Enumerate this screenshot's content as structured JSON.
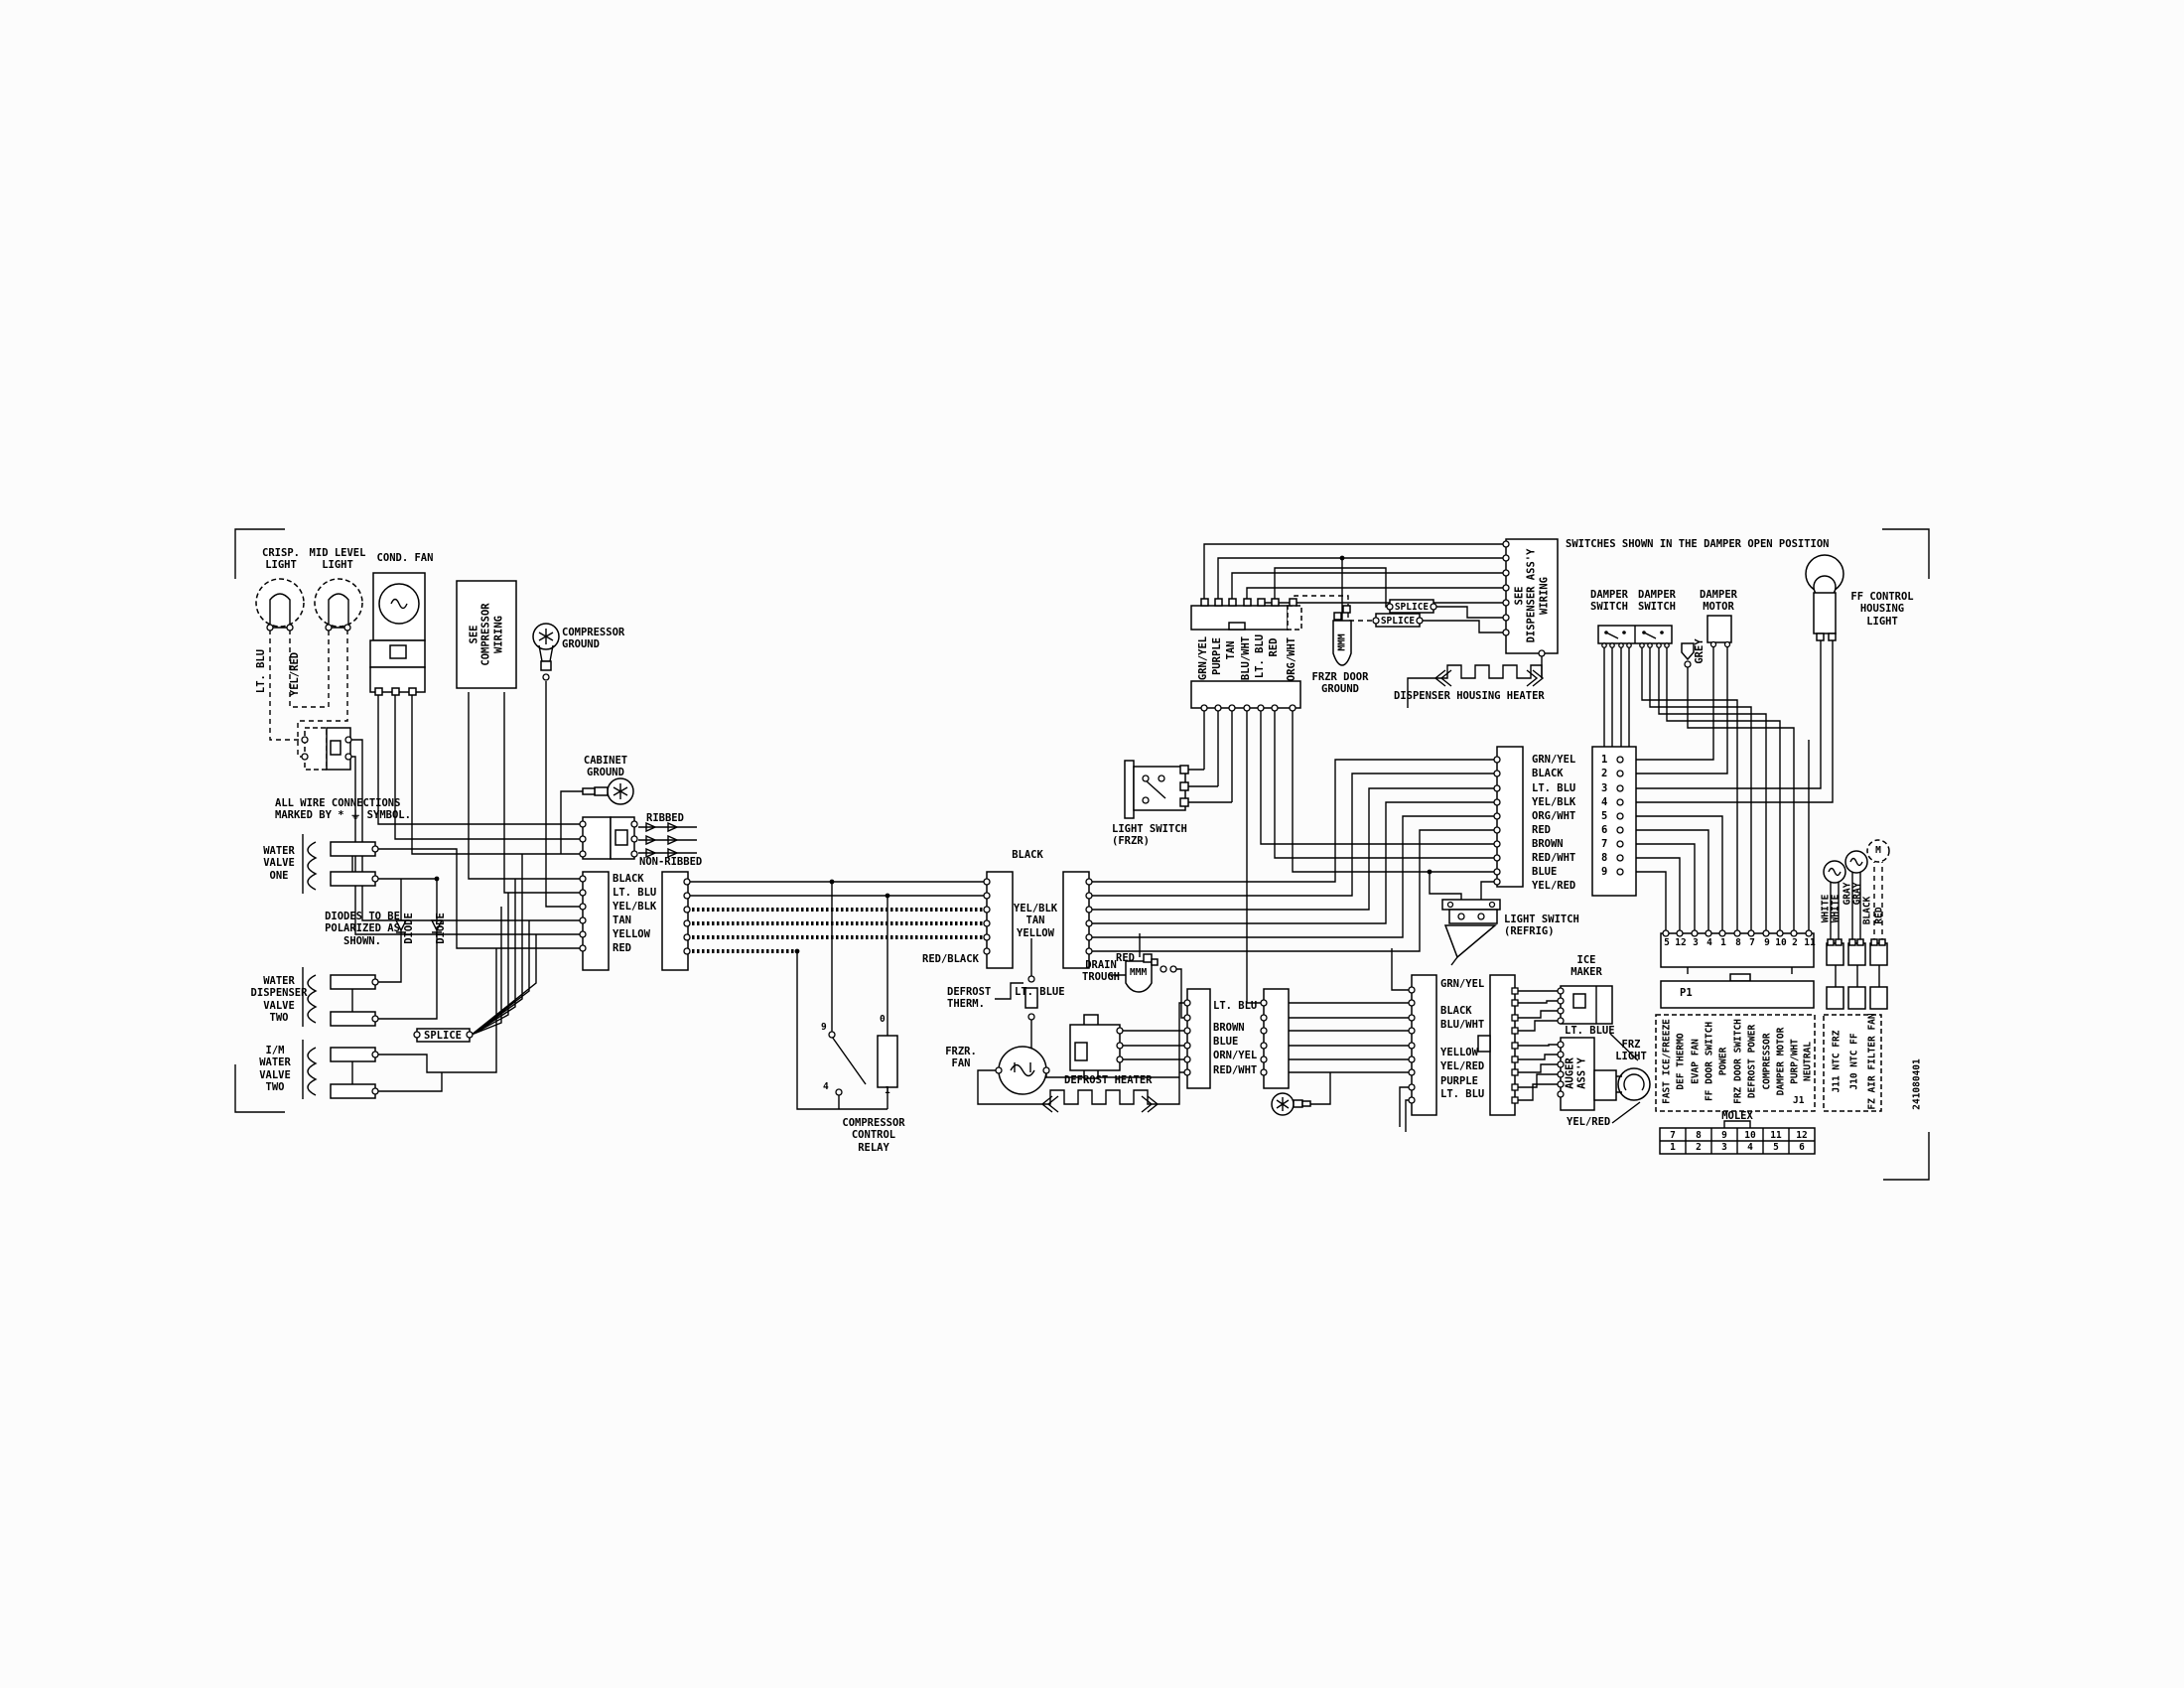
{
  "t": {
    "crisp_light": "CRISP.\nLIGHT",
    "mid_level_light": "MID LEVEL\nLIGHT",
    "cond_fan": "COND. FAN",
    "see_compressor_wiring": "SEE\nCOMPRESSOR\nWIRING",
    "compressor_ground": "COMPRESSOR\nGROUND",
    "lt_blu": "LT. BLU",
    "yel_red": "YEL/RED",
    "cabinet_ground": "CABINET\nGROUND",
    "wire_note": "ALL WIRE CONNECTIONS\nMARKED BY * ⏚ SYMBOL.",
    "water_valve_one": "WATER\nVALVE\nONE",
    "diode_note": "DIODES TO BE\nPOLARIZED AS\nSHOWN.",
    "diode": "DIODE",
    "water_dispenser_valve_two": "WATER\nDISPENSER\nVALVE\nTWO",
    "im_water_valve_two": "I/M\nWATER\nVALVE\nTWO",
    "splice": "SPLICE",
    "ribbed": "RIBBED",
    "non_ribbed": "NON-RIBBED",
    "black": "B LACK",
    "black2": "BLACK",
    "yel_blk_tan_yellow": "YEL/BLK\nTAN\nYELLOW",
    "red_black": "RED/BLACK",
    "compressor_control_relay": "COMPRESSOR\nCONTROL\nRELAY",
    "relay_pin_9": "9",
    "relay_pin_4": "4",
    "relay_pin_0": "0",
    "relay_pin_1": "1",
    "defrost_therm": "DEFROST\nTHERM.",
    "lt_blue": "LT. BLUE",
    "frzr_fan": "FRZR.\nFAN",
    "defrost_heater": "DEFROST HEATER",
    "drain_trough": "DRAIN\nTROUGH",
    "red": "RED",
    "mmm": "MMM",
    "light_switch_frzr": "LIGHT SWITCH\n(FRZR)",
    "ice_maker": "ICE\nMAKER",
    "auger_assy": "AUGER\nASS'Y",
    "frz_light": "FRZ\nLIGHT",
    "frzr_door_ground": "FRZR DOOR\nGROUND",
    "see_dispenser_wiring": "SEE\nDISPENSER ASS'Y\nWIRING",
    "dispenser_housing_heater": "DISPENSER HOUSING HEATER",
    "switches_note": "SWITCHES SHOWN IN THE DAMPER OPEN POSITION",
    "damper_switch": "DAMPER\nSWITCH",
    "damper_motor": "DAMPER\nMOTOR",
    "grey": "GREY",
    "ff_control_housing_light": "FF CONTROL\nHOUSING\nLIGHT",
    "light_switch_refrig": "LIGHT SWITCH\n(REFRIG)",
    "p1": "P1",
    "j1": "J1",
    "molex": "MOLEX",
    "part_number": "241080401",
    "white": "WHITE",
    "gray": "GRAY",
    "black_wire": "BLACK",
    "red_wire": "RED",
    "m": "M"
  },
  "conn_harness_colors": [
    "BLACK",
    "LT. BLU",
    "YEL/BLK",
    "TAN",
    "YELLOW",
    "RED"
  ],
  "conn_defrost_colors": [
    "LT. BLU",
    "BROWN",
    "BLUE",
    "ORN/YEL",
    "RED/WHT"
  ],
  "conn_auger_colors": [
    "GRN/YEL",
    "BLACK",
    "BLU/WHT",
    "YELLOW",
    "YEL/RED",
    "PURPLE",
    "LT. BLU"
  ],
  "conn_dispenser_colors": [
    "GRN/YEL",
    "PURPLE",
    "TAN",
    "BLU/WHT",
    "LT. BLU",
    "RED",
    "ORG/WHT"
  ],
  "conn_main_colors": [
    "GRN/YEL",
    "BLACK",
    "LT. BLU",
    "YEL/BLK",
    "ORG/WHT",
    "RED",
    "BROWN",
    "RED/WHT",
    "BLUE",
    "YEL/RED"
  ],
  "conn_main_pins": [
    "1",
    "2",
    "3",
    "4",
    "5",
    "6",
    "7",
    "8",
    "9"
  ],
  "conn_board_pins": [
    "5",
    "12",
    "3",
    "4",
    "1",
    "8",
    "7",
    "9",
    "10",
    "2",
    "11"
  ],
  "j1_signals": [
    "FAST ICE/FREEZE",
    "DEF THERMO",
    "EVAP FAN",
    "FF DOOR SWITCH",
    "POWER",
    "FRZ DOOR SWITCH",
    "DEFROST POWER",
    "COMPRESSOR",
    "DAMPER MOTOR",
    "PURP/WHT",
    "NEUTRAL"
  ],
  "j11_signals": [
    "J11 NTC FRZ",
    "J10 NTC FF",
    "FZ AIR FILTER FAN"
  ],
  "molex_top": [
    "7",
    "8",
    "9",
    "10",
    "11",
    "12"
  ],
  "molex_bottom": [
    "1",
    "2",
    "3",
    "4",
    "5",
    "6"
  ]
}
